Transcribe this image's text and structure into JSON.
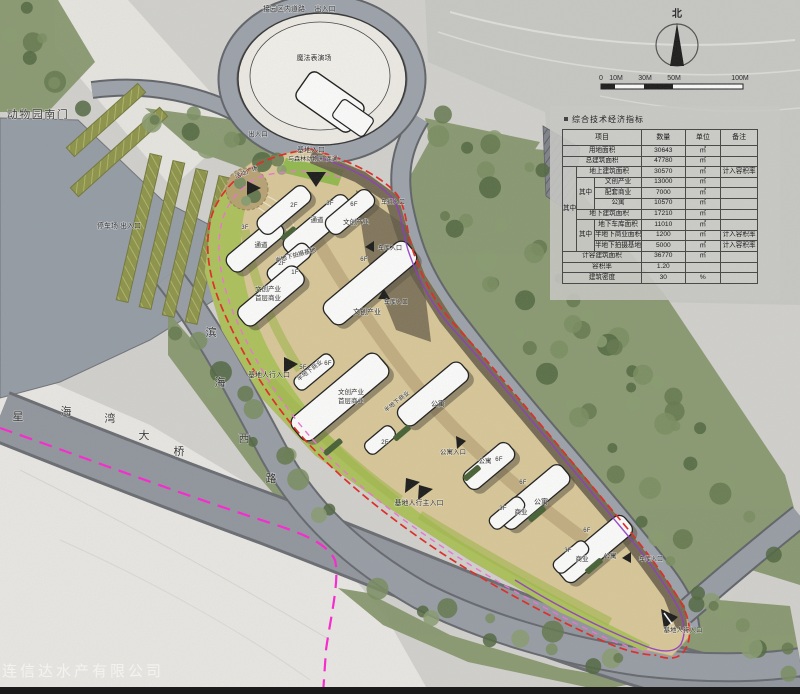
{
  "map_labels": {
    "park_road": "接园区内道路",
    "entrance_exit": "出入口",
    "magic_venue": "魔法表演场",
    "zoo_south_gate": "动物园南门",
    "parking_exit": "停车场 出入口",
    "site_entrance": "基地入口",
    "zoo_connection": "与森林动物园 连通",
    "activity_plaza": "活动广场",
    "passage": "通道",
    "cultural_industry": "文创产业",
    "cultural_line2": "首层商业",
    "semi_underground_studio": "半地下拍摄基地",
    "semi_underground_commercial": "半地下商业",
    "garage_entrance": "车库入口",
    "vehicle_entrance": "车行入口",
    "apartment": "公寓",
    "apartment_entrance": "公寓入口",
    "commercial": "商业",
    "site_ped_entrance": "基地人行入口",
    "site_main_ped_entrance": "基地人行主入口",
    "north": "北",
    "watermark": "大连信达水产有限公司",
    "binhai_road": [
      "滨",
      "海",
      "西",
      "路"
    ],
    "bridge": [
      "星",
      "海",
      "湾",
      "大",
      "桥"
    ]
  },
  "floors": {
    "f1": "1F",
    "f2": "2F",
    "f3": "3F",
    "f5": "5F",
    "f6": "6F"
  },
  "scale_bar": {
    "ticks": [
      "0",
      "10M",
      "30M",
      "50M",
      "100M"
    ]
  },
  "table": {
    "title": "综合技术经济指标",
    "headers": {
      "item": "项目",
      "qty": "数量",
      "unit": "单位",
      "note": "备注"
    },
    "among": "其中",
    "rows": [
      {
        "item": "用地面积",
        "qty": "30643",
        "unit": "㎡",
        "note": ""
      },
      {
        "item": "总建筑面积",
        "qty": "47780",
        "unit": "㎡",
        "note": ""
      },
      {
        "item": "地上建筑面积",
        "qty": "30570",
        "unit": "㎡",
        "note": "计入容积率"
      },
      {
        "item": "文创产业",
        "qty": "13000",
        "unit": "㎡",
        "note": ""
      },
      {
        "item": "配套商业",
        "qty": "7000",
        "unit": "㎡",
        "note": ""
      },
      {
        "item": "公寓",
        "qty": "10570",
        "unit": "㎡",
        "note": ""
      },
      {
        "item": "地下建筑面积",
        "qty": "17210",
        "unit": "㎡",
        "note": ""
      },
      {
        "item": "地下车库面积",
        "qty": "11010",
        "unit": "㎡",
        "note": ""
      },
      {
        "item": "半地下商业面积",
        "qty": "1200",
        "unit": "㎡",
        "note": "计入容积率"
      },
      {
        "item": "半地下拍摄基地",
        "qty": "5000",
        "unit": "㎡",
        "note": "计入容积率"
      },
      {
        "item": "计容建筑面积",
        "qty": "36770",
        "unit": "㎡",
        "note": ""
      },
      {
        "item": "容积率",
        "qty": "1.20",
        "unit": "",
        "note": ""
      },
      {
        "item": "建筑密度",
        "qty": "30",
        "unit": "%",
        "note": ""
      }
    ]
  },
  "colors": {
    "boundary_red": "#e31f1a",
    "metro_magenta": "#ff1bd2",
    "edge_violet": "#8b2fc9",
    "pink_dash": "#ee6fd4",
    "lawn_green": "#abc155",
    "site_tan": "#d9c795",
    "road_gray": "#9aa0a9"
  }
}
